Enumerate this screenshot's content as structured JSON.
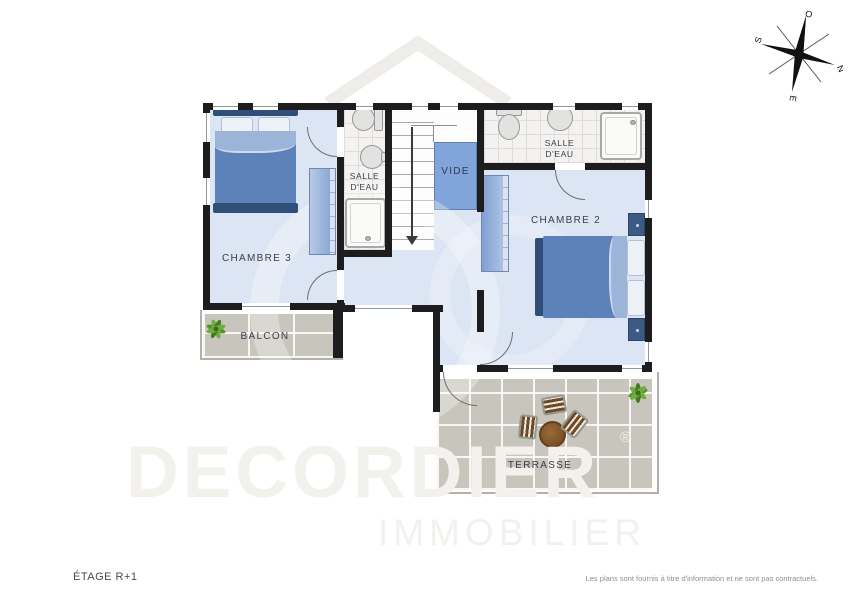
{
  "footer": {
    "floor_label": "ÉTAGE R+1",
    "disclaimer": "Les plans sont fournis à titre d'information et ne sont pas contractuels."
  },
  "watermark": {
    "brand": "DECORDIER",
    "registered": "®",
    "subtitle": "IMMOBILIER"
  },
  "compass": {
    "north": "N",
    "south": "S",
    "east": "E",
    "west": "O"
  },
  "rooms": {
    "chambre3": {
      "label": "CHAMBRE 3"
    },
    "chambre2": {
      "label": "CHAMBRE 2"
    },
    "salle_deau_ouest": {
      "line1": "SALLE",
      "line2": "D'EAU"
    },
    "salle_deau_est": {
      "line1": "SALLE",
      "line2": "D'EAU"
    },
    "vide": {
      "label": "VIDE"
    },
    "balcon": {
      "label": "BALCON"
    },
    "terrasse": {
      "label": "TERRASSE"
    }
  },
  "colors": {
    "wall": "#1d1d20",
    "bedroom_floor": "#dbe5f4",
    "bathroom_tile": "#f3f2f1",
    "outdoor_tile": "#c8c5bd",
    "bed_blue": "#5d82ba",
    "bed_frame": "#2f4e78",
    "vide_fill": "#81a5da",
    "plant_green": "#55912f",
    "table_brown": "#7a4e25",
    "watermark_gray": "#f2f1ee"
  }
}
